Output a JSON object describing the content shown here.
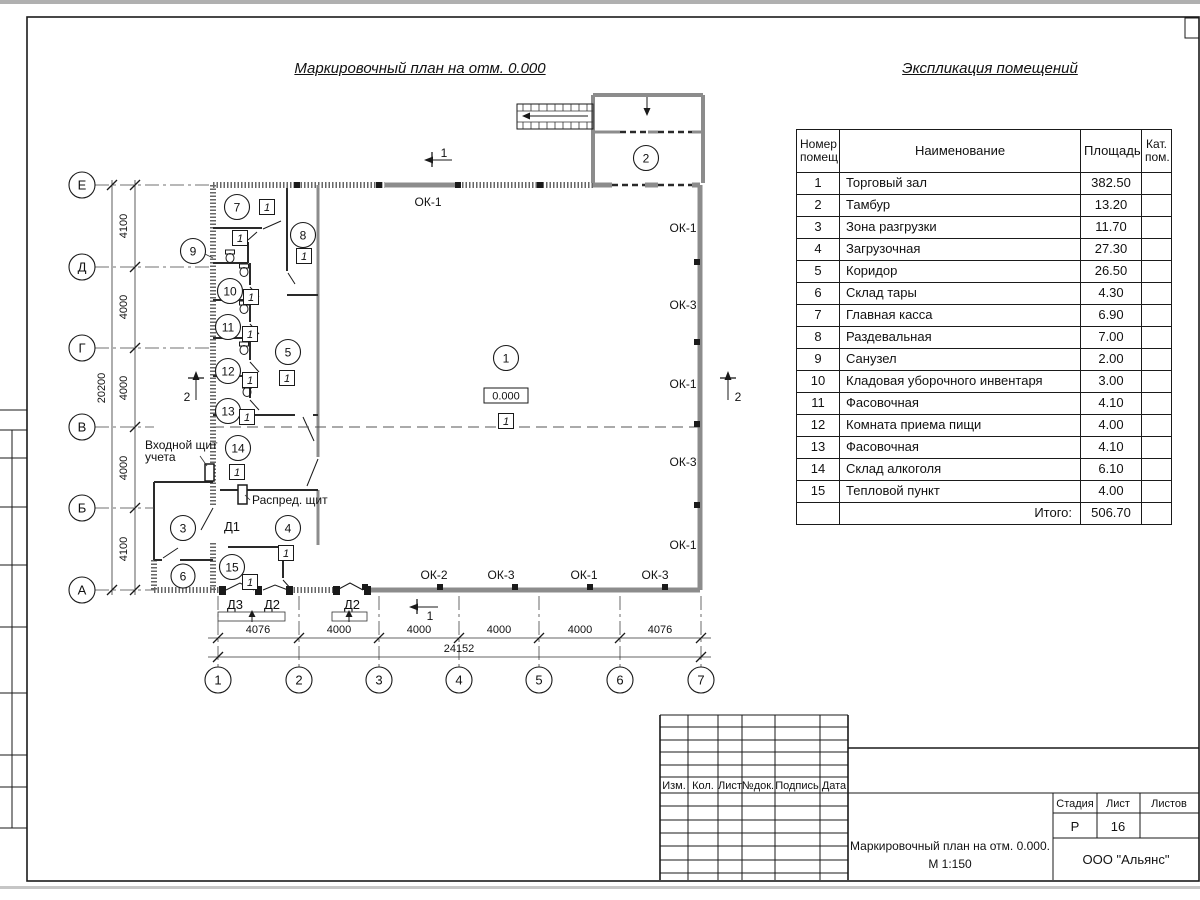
{
  "sheet": {
    "plan_title": "Маркировочный план на отм. 0.000",
    "explication_title": "Экспликация помещений"
  },
  "explication": {
    "headers": {
      "num": "Номер помещ.",
      "name": "Наименование",
      "area": "Площадь",
      "cat": "Кат. пом."
    },
    "rows": [
      {
        "num": "1",
        "name": "Торговый зал",
        "area": "382.50"
      },
      {
        "num": "2",
        "name": "Тамбур",
        "area": "13.20"
      },
      {
        "num": "3",
        "name": "Зона разгрузки",
        "area": "11.70"
      },
      {
        "num": "4",
        "name": "Загрузочная",
        "area": "27.30"
      },
      {
        "num": "5",
        "name": "Коридор",
        "area": "26.50"
      },
      {
        "num": "6",
        "name": "Склад тары",
        "area": "4.30"
      },
      {
        "num": "7",
        "name": "Главная касса",
        "area": "6.90"
      },
      {
        "num": "8",
        "name": "Раздевальная",
        "area": "7.00"
      },
      {
        "num": "9",
        "name": "Санузел",
        "area": "2.00"
      },
      {
        "num": "10",
        "name": "Кладовая уборочного инвентаря",
        "area": "3.00"
      },
      {
        "num": "11",
        "name": "Фасовочная",
        "area": "4.10"
      },
      {
        "num": "12",
        "name": "Комната приема пищи",
        "area": "4.00"
      },
      {
        "num": "13",
        "name": "Фасовочная",
        "area": "4.10"
      },
      {
        "num": "14",
        "name": "Склад алкоголя",
        "area": "6.10"
      },
      {
        "num": "15",
        "name": "Тепловой пункт",
        "area": "4.00"
      }
    ],
    "total_label": "Итого:",
    "total_value": "506.70"
  },
  "plan": {
    "elevation": "0.000",
    "floor_marker": "1",
    "rooms": [
      "1",
      "2",
      "3",
      "4",
      "5",
      "6",
      "7",
      "8",
      "9",
      "10",
      "11",
      "12",
      "13",
      "14",
      "15"
    ],
    "axis_letters": [
      "Е",
      "Д",
      "Г",
      "В",
      "Б",
      "А"
    ],
    "axis_numbers": [
      "1",
      "2",
      "3",
      "4",
      "5",
      "6",
      "7"
    ],
    "dims_bottom": [
      "4076",
      "4000",
      "4000",
      "4000",
      "4000",
      "4076"
    ],
    "dim_bottom_total": "24152",
    "dims_left": [
      "4100",
      "4000",
      "4000",
      "4000",
      "4100"
    ],
    "dim_left_total": "20200",
    "window_top": "ОК-1",
    "windows_right": [
      "ОК-1",
      "ОК-3",
      "ОК-1",
      "ОК-3",
      "ОК-1"
    ],
    "windows_bottom": [
      "ОК-2",
      "ОК-3",
      "ОК-1",
      "ОК-3"
    ],
    "doors": {
      "d1": "Д1",
      "d2": "Д2",
      "d3": "Д3"
    },
    "labels": {
      "entry_panel_line1": "Входной щит",
      "entry_panel_line2": "учета",
      "dist_panel": "Распред. щит"
    },
    "sections": {
      "s1": "1",
      "s2": "2"
    }
  },
  "title_block": {
    "columns": [
      "Изм.",
      "Кол.",
      "Лист",
      "№док.",
      "Подпись",
      "Дата"
    ],
    "stage_label": "Стадия",
    "stage_value": "Р",
    "sheet_label": "Лист",
    "sheet_value": "16",
    "sheets_label": "Листов",
    "doc_title_line1": "Маркировочный план на отм. 0.000.",
    "doc_title_line2": "М 1:150",
    "company": "ООО \"Альянс\""
  }
}
